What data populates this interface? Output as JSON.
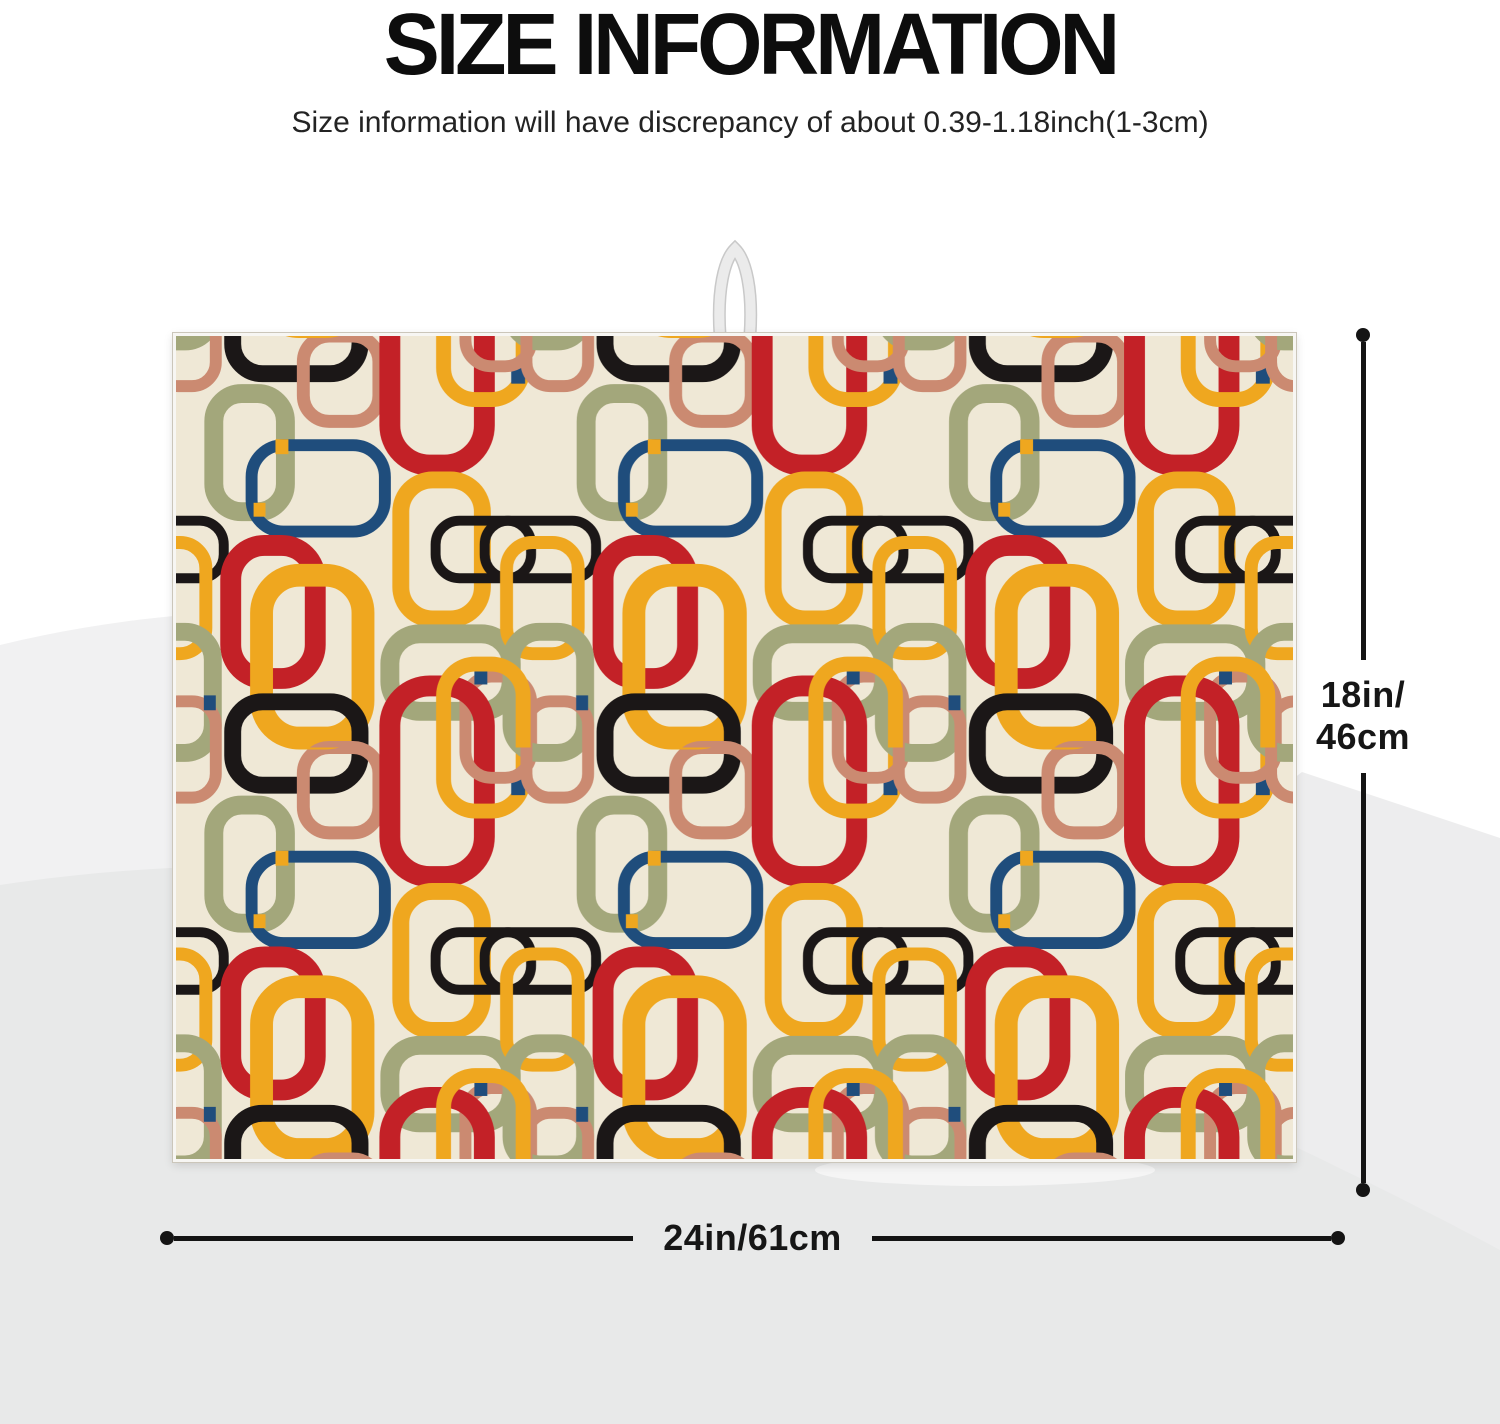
{
  "header": {
    "title": "SIZE INFORMATION",
    "subtitle": "Size information will have discrepancy of about 0.39-1.18inch(1-3cm)"
  },
  "dimensions": {
    "height_label_line1": "18in/",
    "height_label_line2": "46cm",
    "width_label": "24in/61cm"
  },
  "mat": {
    "pattern_name": "retro-rounded-rectangle-rings",
    "hanger": "white-ribbon-loop"
  },
  "colors": {
    "accent_red": "#c32127",
    "accent_yellow": "#efa71f",
    "accent_black": "#1b1717",
    "accent_olive": "#a3a77b",
    "accent_navy": "#1f4d7c",
    "accent_salmon": "#cb8a71",
    "mat_background": "#efe8d6",
    "dimension_line": "#141414",
    "page_background": "#ffffff",
    "background_shade_light": "#f1f1f2",
    "background_shade_mid": "#ededee",
    "background_shade_dark": "#e8e9e9"
  }
}
